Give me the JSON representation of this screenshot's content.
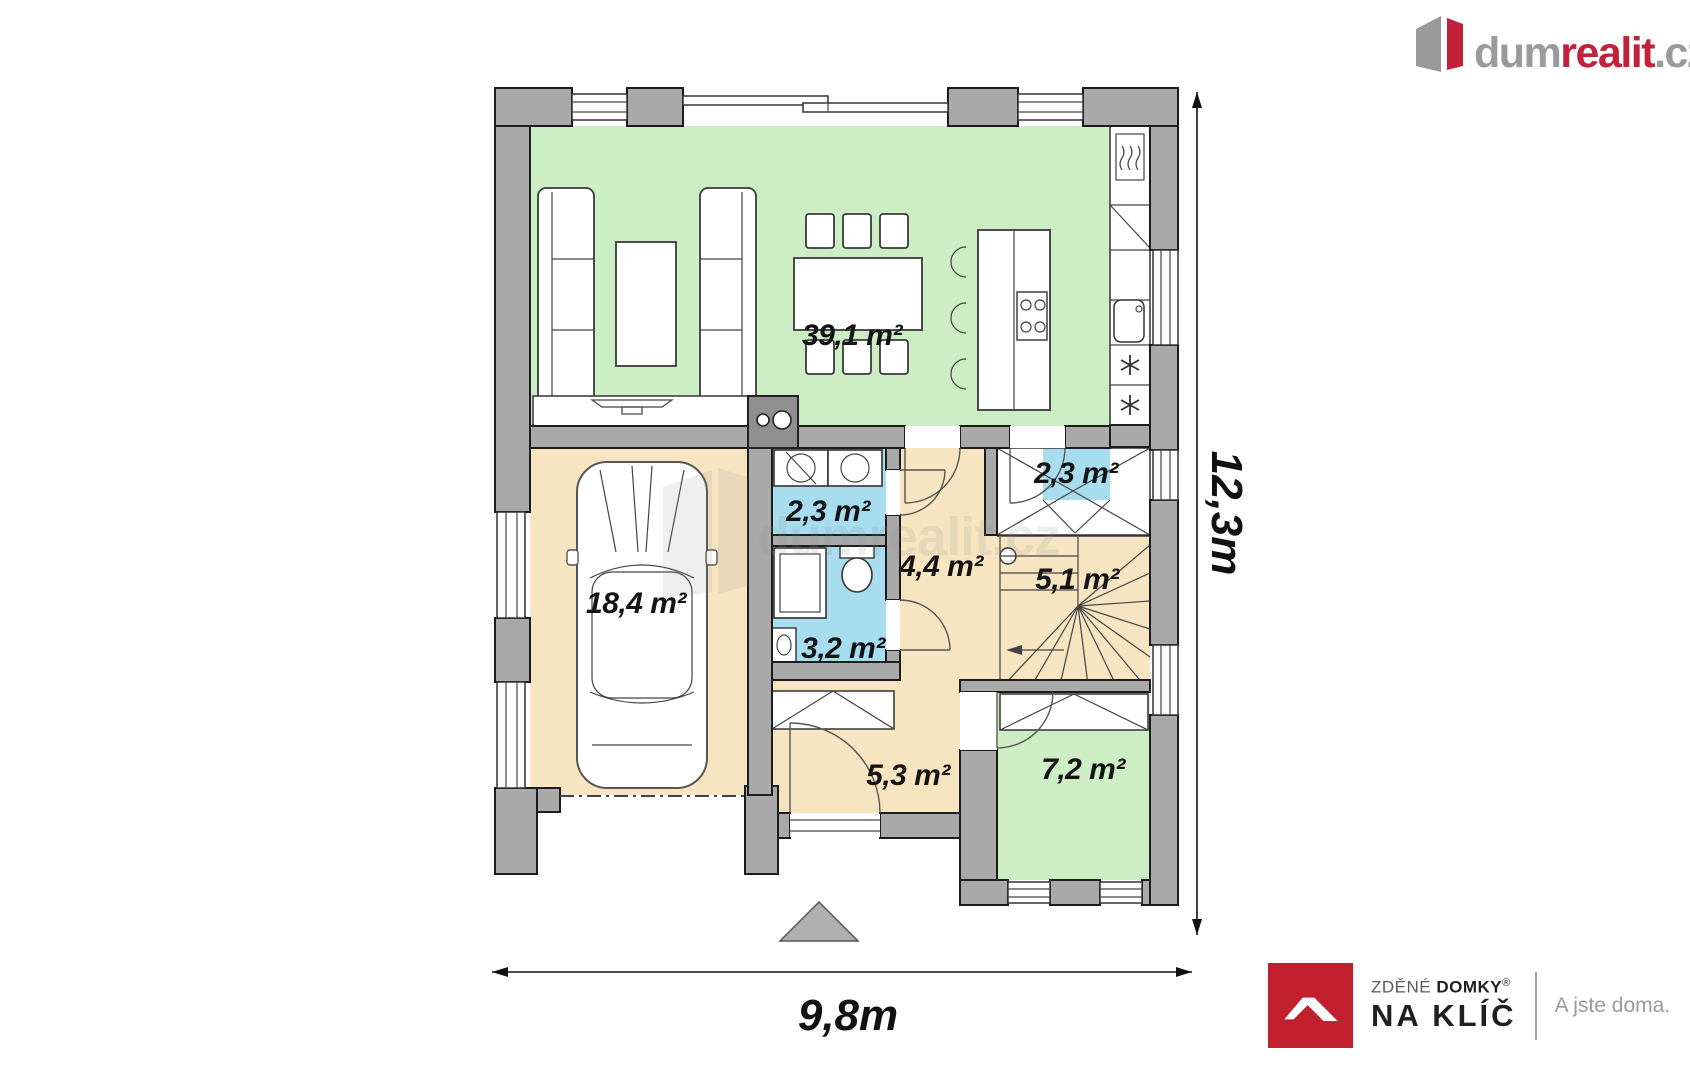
{
  "header": {
    "brand": {
      "part1": "dum",
      "part2": "realit",
      "part3": ".cz"
    }
  },
  "watermark": {
    "text": "dumrealit.cz"
  },
  "floorplan": {
    "rooms": [
      {
        "id": "living-kitchen",
        "label": "39,1 m²"
      },
      {
        "id": "garage",
        "label": "18,4 m²"
      },
      {
        "id": "utility",
        "label": "2,3 m²"
      },
      {
        "id": "bathroom",
        "label": "3,2 m²"
      },
      {
        "id": "hall",
        "label": "4,4 m²"
      },
      {
        "id": "entry-vestibule",
        "label": "2,3 m²"
      },
      {
        "id": "staircase",
        "label": "5,1 m²"
      },
      {
        "id": "corridor",
        "label": "5,3 m²"
      },
      {
        "id": "study",
        "label": "7,2 m²"
      }
    ],
    "dimensions": {
      "width": "9,8m",
      "height": "12,3m"
    },
    "colors": {
      "wall": "#a9a9a9",
      "living_green": "#cdeec4",
      "floor_beige": "#f7e5c1",
      "wet_room_blue": "#a8ddf0",
      "brand_red": "#c1223a",
      "brand_gray": "#9a9a9a",
      "builder_red": "#c2202e"
    }
  },
  "footer_logo": {
    "line1_light": "ZDĚNÉ",
    "line1_bold": "DOMKY",
    "registered": "®",
    "line2": "NA KLÍČ",
    "tagline": "A jste doma."
  }
}
